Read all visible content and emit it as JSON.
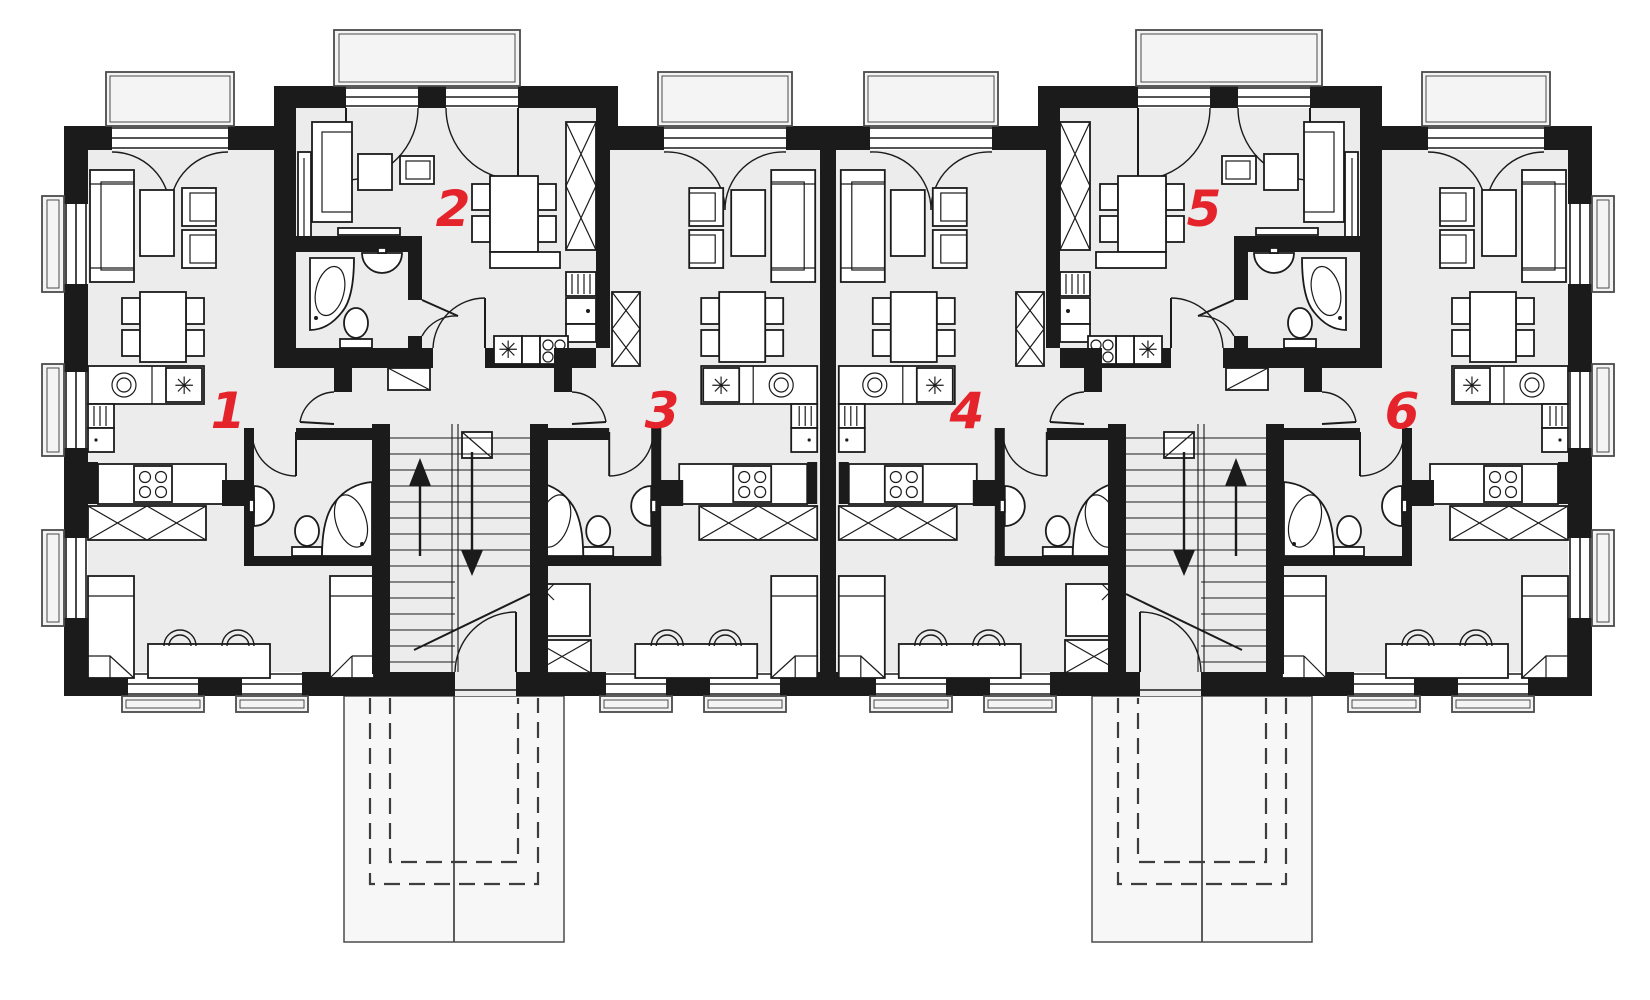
{
  "plan": {
    "kind": "apartment-building-ground-floor-plan",
    "units_total": 6,
    "stairwells": 2,
    "entrance_porches": 2
  },
  "apartments": [
    {
      "label": "1"
    },
    {
      "label": "2"
    },
    {
      "label": "3"
    },
    {
      "label": "4"
    },
    {
      "label": "5"
    },
    {
      "label": "6"
    }
  ],
  "icons": {
    "fridge_asterisk": "✳"
  },
  "colors": {
    "label_red": "#e4232b",
    "wall": "#1b1b1b",
    "floor": "#ececec"
  }
}
